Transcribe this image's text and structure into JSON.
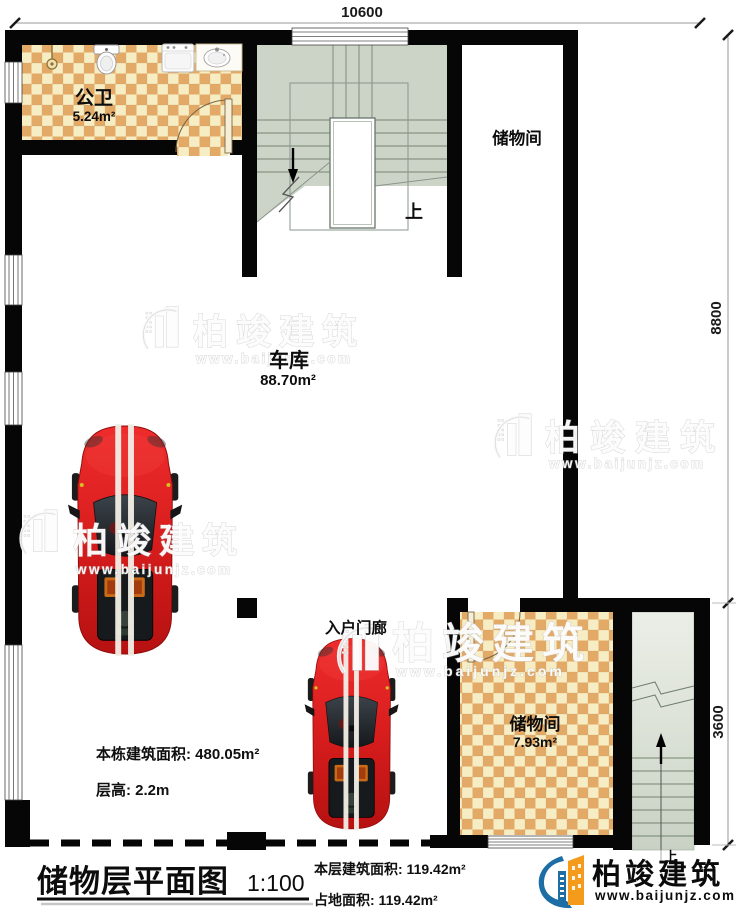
{
  "plan": {
    "dimensions": {
      "width_top": "10600",
      "height_upper_right": "8800",
      "height_lower_right": "3600"
    },
    "rooms": {
      "bathroom": {
        "name": "公卫",
        "area": "5.24m²"
      },
      "storage_top": {
        "name": "储物间"
      },
      "garage": {
        "name": "车库",
        "area": "88.70m²"
      },
      "entry_porch": {
        "name": "入户门廊"
      },
      "storage_bottom": {
        "name": "储物间",
        "area": "7.93m²"
      }
    },
    "stairs": {
      "up_label_main": "上",
      "up_label_entry": "上"
    }
  },
  "notes": {
    "building_total_area": "本栋建筑面积: 480.05m²",
    "floor_height": "层高: 2.2m"
  },
  "title_block": {
    "title": "储物层平面图",
    "scale": "1:100",
    "floor_area": "本层建筑面积: 119.42m²",
    "footprint_area": "占地面积: 119.42m²"
  },
  "brand": {
    "name": "柏竣建筑",
    "website": "www.baijunjz.com"
  },
  "watermark": {
    "text": "柏竣建筑",
    "website": "www.baijunjz.com"
  },
  "colors": {
    "wall": "#060606",
    "tile_dark": "#e3aa67",
    "tile_light": "#f7edc4",
    "stair": "#ccd4c8",
    "car_red": "#d42020",
    "brand_blue": "#1c6ea4",
    "brand_orange": "#f59b1c"
  }
}
